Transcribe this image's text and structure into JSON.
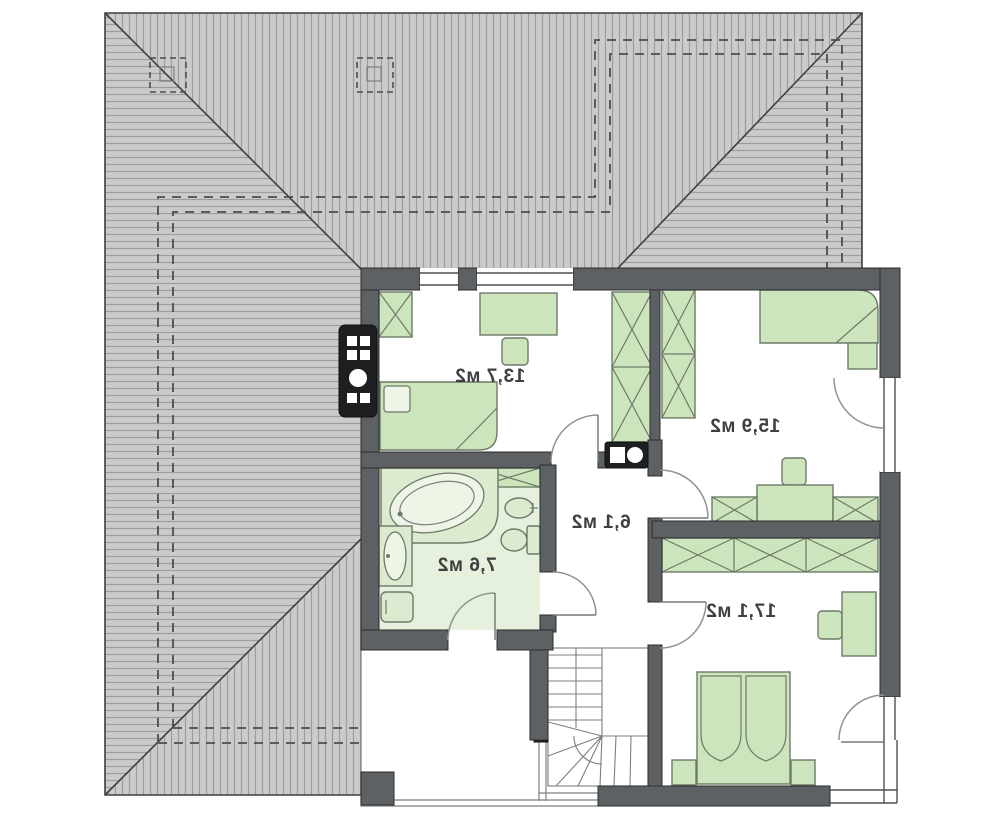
{
  "plan": {
    "labels_mirrored": true,
    "rooms": [
      {
        "id": "bedroom-top-left",
        "area_label": "13,7 м2",
        "area_m2": 13.7
      },
      {
        "id": "bedroom-top-right",
        "area_label": "15,9 м2",
        "area_m2": 15.9
      },
      {
        "id": "hall",
        "area_label": "6,1 м2",
        "area_m2": 6.1
      },
      {
        "id": "bathroom",
        "area_label": "7,6 м2",
        "area_m2": 7.6
      },
      {
        "id": "bedroom-bottom-right",
        "area_label": "17,1 м2",
        "area_m2": 17.1
      }
    ]
  },
  "colors": {
    "wall": "#5d6164",
    "fixture_dark": "#1d1f20",
    "roof_fill": "#cbcbcb",
    "roof_hatch": "#9d9d9d",
    "roof_line": "#3e3e3e",
    "furniture_fill": "#cde5bd",
    "furniture_stroke": "#6d7a68",
    "fixture_fill": "#dcebd0",
    "bathroom_floor": "#e5f0dd",
    "label_color": "#3f3f3f"
  }
}
